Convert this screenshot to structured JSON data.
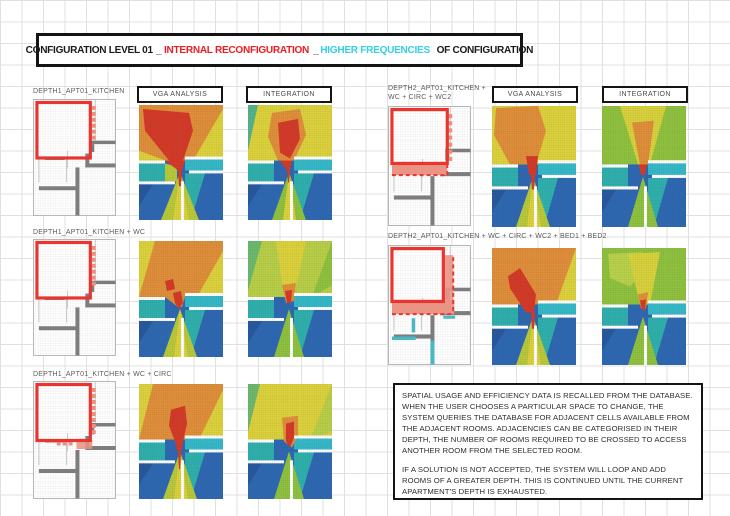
{
  "title": {
    "seg1": "CONFIGURATION LEVEL 01",
    "sep1": "_",
    "seg2": "INTERNAL RECONFIGURATION",
    "sep2": "_",
    "seg3": "HIGHER FREQUENCIES",
    "seg4": " OF CONFIGURATION"
  },
  "left_column": {
    "vga_header": "VGA ANALYSIS",
    "integration_header": "INTEGRATION",
    "rows": [
      {
        "label": "DEPTH1_APT01_KITCHEN"
      },
      {
        "label": "DEPTH1_APT01_KITCHEN + WC"
      },
      {
        "label": "DEPTH1_APT01_KITCHEN + WC + CIRC"
      }
    ]
  },
  "right_column": {
    "vga_header": "VGA ANALYSIS",
    "integration_header": "INTEGRATION",
    "rows": [
      {
        "label_line1": "DEPTH2_APT01_KITCHEN +",
        "label_line2": "WC + CIRC + WC2"
      },
      {
        "label": "DEPTH2_APT01_KITCHEN + WC + CIRC + WC2 + BED1 + BED2"
      }
    ]
  },
  "info_box": {
    "paragraph1": "SPATIAL USAGE AND EFFICIENCY DATA IS RECALLED FROM THE DATABASE. WHEN THE USER CHOOSES A PARTICULAR SPACE TO CHANGE, THE SYSTEM QUERIES THE DATABASE FOR ADJACENT CELLS AVAILABLE FROM THE ADJACENT ROOMS. ADJACENCIES CAN BE CATEGORISED IN THEIR DEPTH, THE NUMBER OF ROOMS REQUIRED TO BE CROSSED TO ACCESS ANOTHER ROOM FROM THE SELECTED ROOM.",
    "paragraph2": "IF A SOLUTION IS NOT ACCEPTED, THE SYSTEM WILL LOOP AND ADD ROOMS OF A GREATER DEPTH. THIS IS CONTINUED UNTIL THE CURRENT APARTMENT'S DEPTH IS EXHAUSTED."
  },
  "colors": {
    "title_red": "#ed1c24",
    "title_cyan": "#35cfe3",
    "heat_red": "#d43a28",
    "heat_orange": "#e08f3a",
    "heat_yellow": "#ddd23c",
    "heat_yellow_green": "#b9c93a",
    "heat_green": "#8fc23f",
    "heat_teal": "#2fb0ad",
    "heat_cyan": "#35b9c9",
    "heat_blue": "#2e68b2",
    "plan_wall_gray": "#7d7d7d",
    "plan_outline_red": "#e8352f",
    "plan_addition_salmon": "#e9917f",
    "plan_changed_teal": "#49b8c4"
  }
}
